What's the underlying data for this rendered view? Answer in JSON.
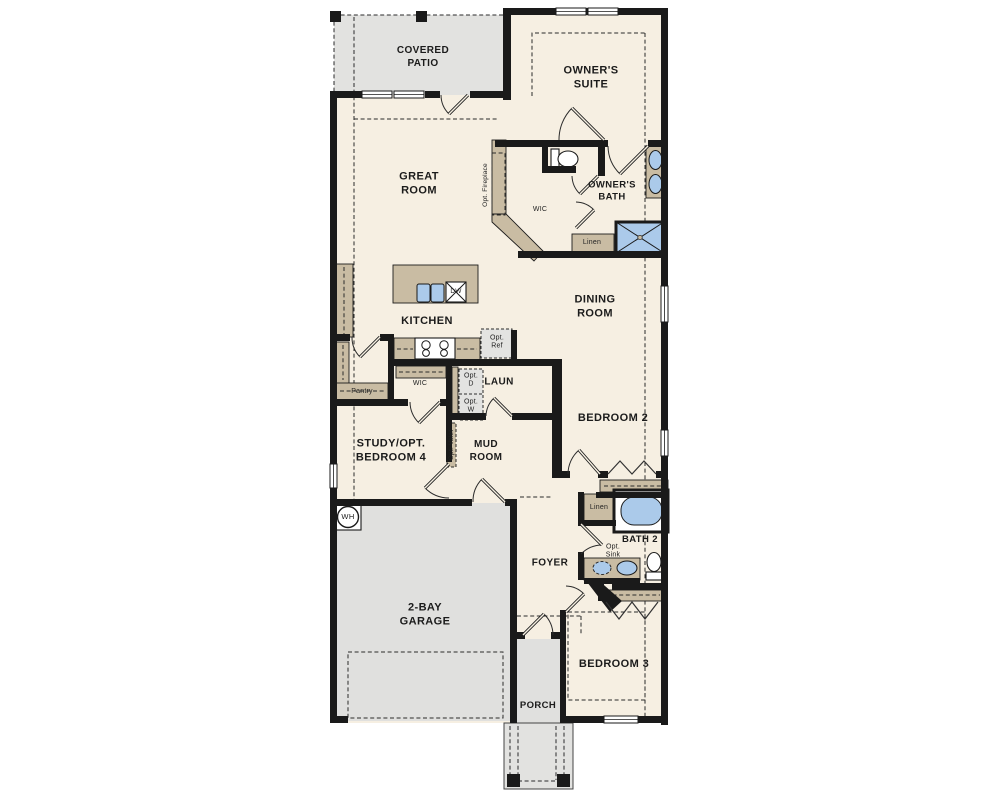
{
  "plan": {
    "rooms": {
      "covered_patio": "COVERED\nPATIO",
      "owners_suite": "OWNER'S\nSUITE",
      "great_room": "GREAT\nROOM",
      "kitchen": "KITCHEN",
      "dining_room": "DINING\nROOM",
      "owners_bath": "OWNER'S\nBATH",
      "wic_owner": "WIC",
      "bedroom_2": "BEDROOM 2",
      "laundry": "LAUN",
      "mud_room": "MUD\nROOM",
      "wic_hall": "WIC",
      "pantry": "Pantry",
      "study": "STUDY/OPT.\nBEDROOM 4",
      "garage": "2-BAY\nGARAGE",
      "foyer": "FOYER",
      "bath_2": "BATH 2",
      "bedroom_3": "BEDROOM 3",
      "porch": "PORCH",
      "linen_owner": "Linen",
      "linen_hall": "Linen"
    },
    "fixtures": {
      "dishwasher": "DW",
      "water_heater": "WH"
    },
    "optional": {
      "fireplace": "Opt. Fireplace",
      "refrigerator": "Opt.\nRef",
      "dryer": "Opt.\nD",
      "washer": "Opt.\nW",
      "valet": "Opt. Valet",
      "sink": "Opt.\nSink"
    },
    "colors": {
      "wall": "#1a1a1a",
      "floor": "#f6efe2",
      "outdoor": "#e2e2e0",
      "cabinet": "#c9bca3",
      "fixture_blue": "#abcaea"
    }
  }
}
